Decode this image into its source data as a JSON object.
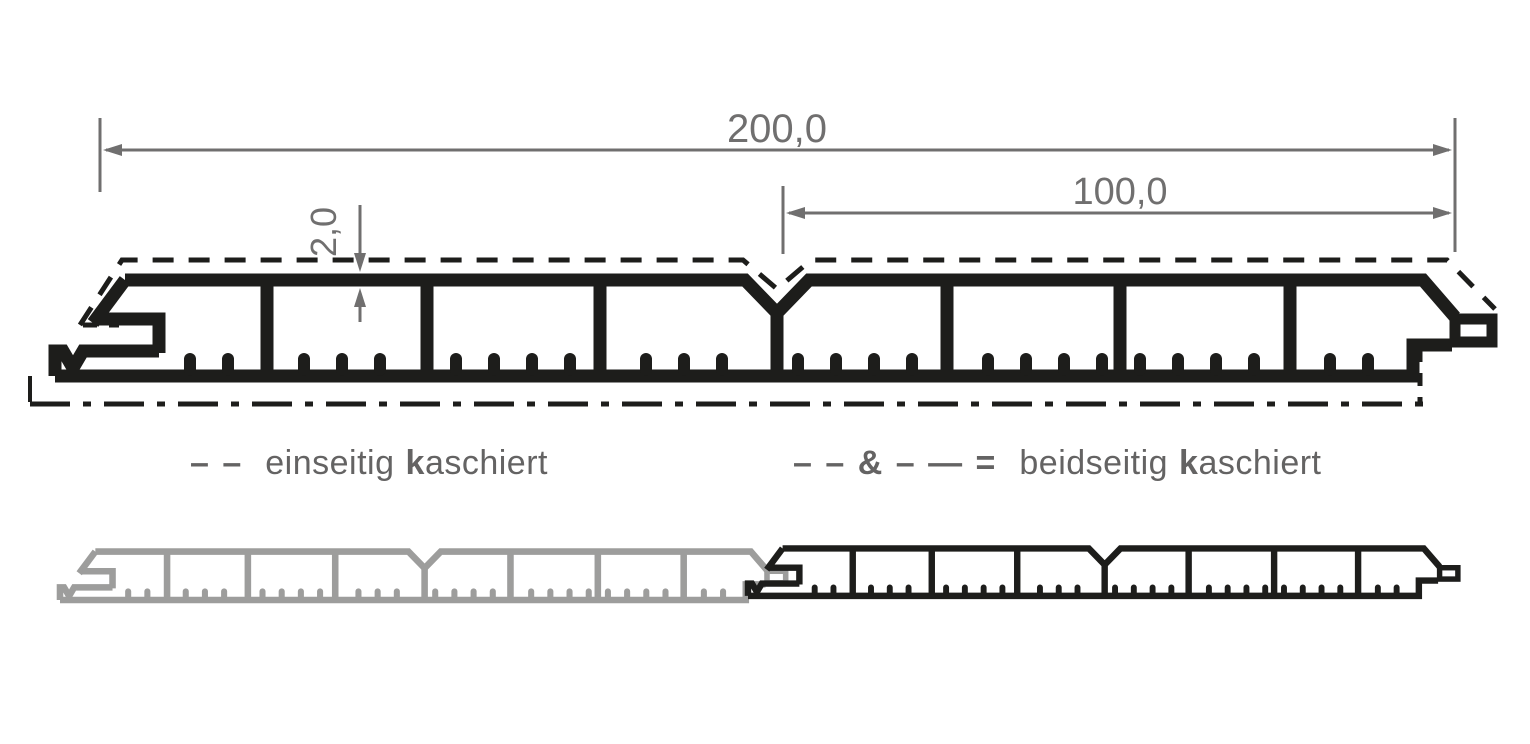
{
  "drawing": {
    "dimension_total": "200,0",
    "dimension_half": "100,0",
    "dimension_thickness": "2,0"
  },
  "legend": {
    "one_sided": {
      "symbol": "– –",
      "word1": "einseitig",
      "bold_letter": "k",
      "word2_rest": "aschiert"
    },
    "two_sided": {
      "symbol": "– – & – — =",
      "word1": "beidseitig",
      "bold_letter": "k",
      "word2_rest": "aschiert"
    }
  },
  "colors": {
    "profile_dark": "#1d1d1b",
    "profile_light": "#9d9d9c",
    "dimension": "#706f6f",
    "legend_text": "#646363",
    "background": "#ffffff"
  }
}
